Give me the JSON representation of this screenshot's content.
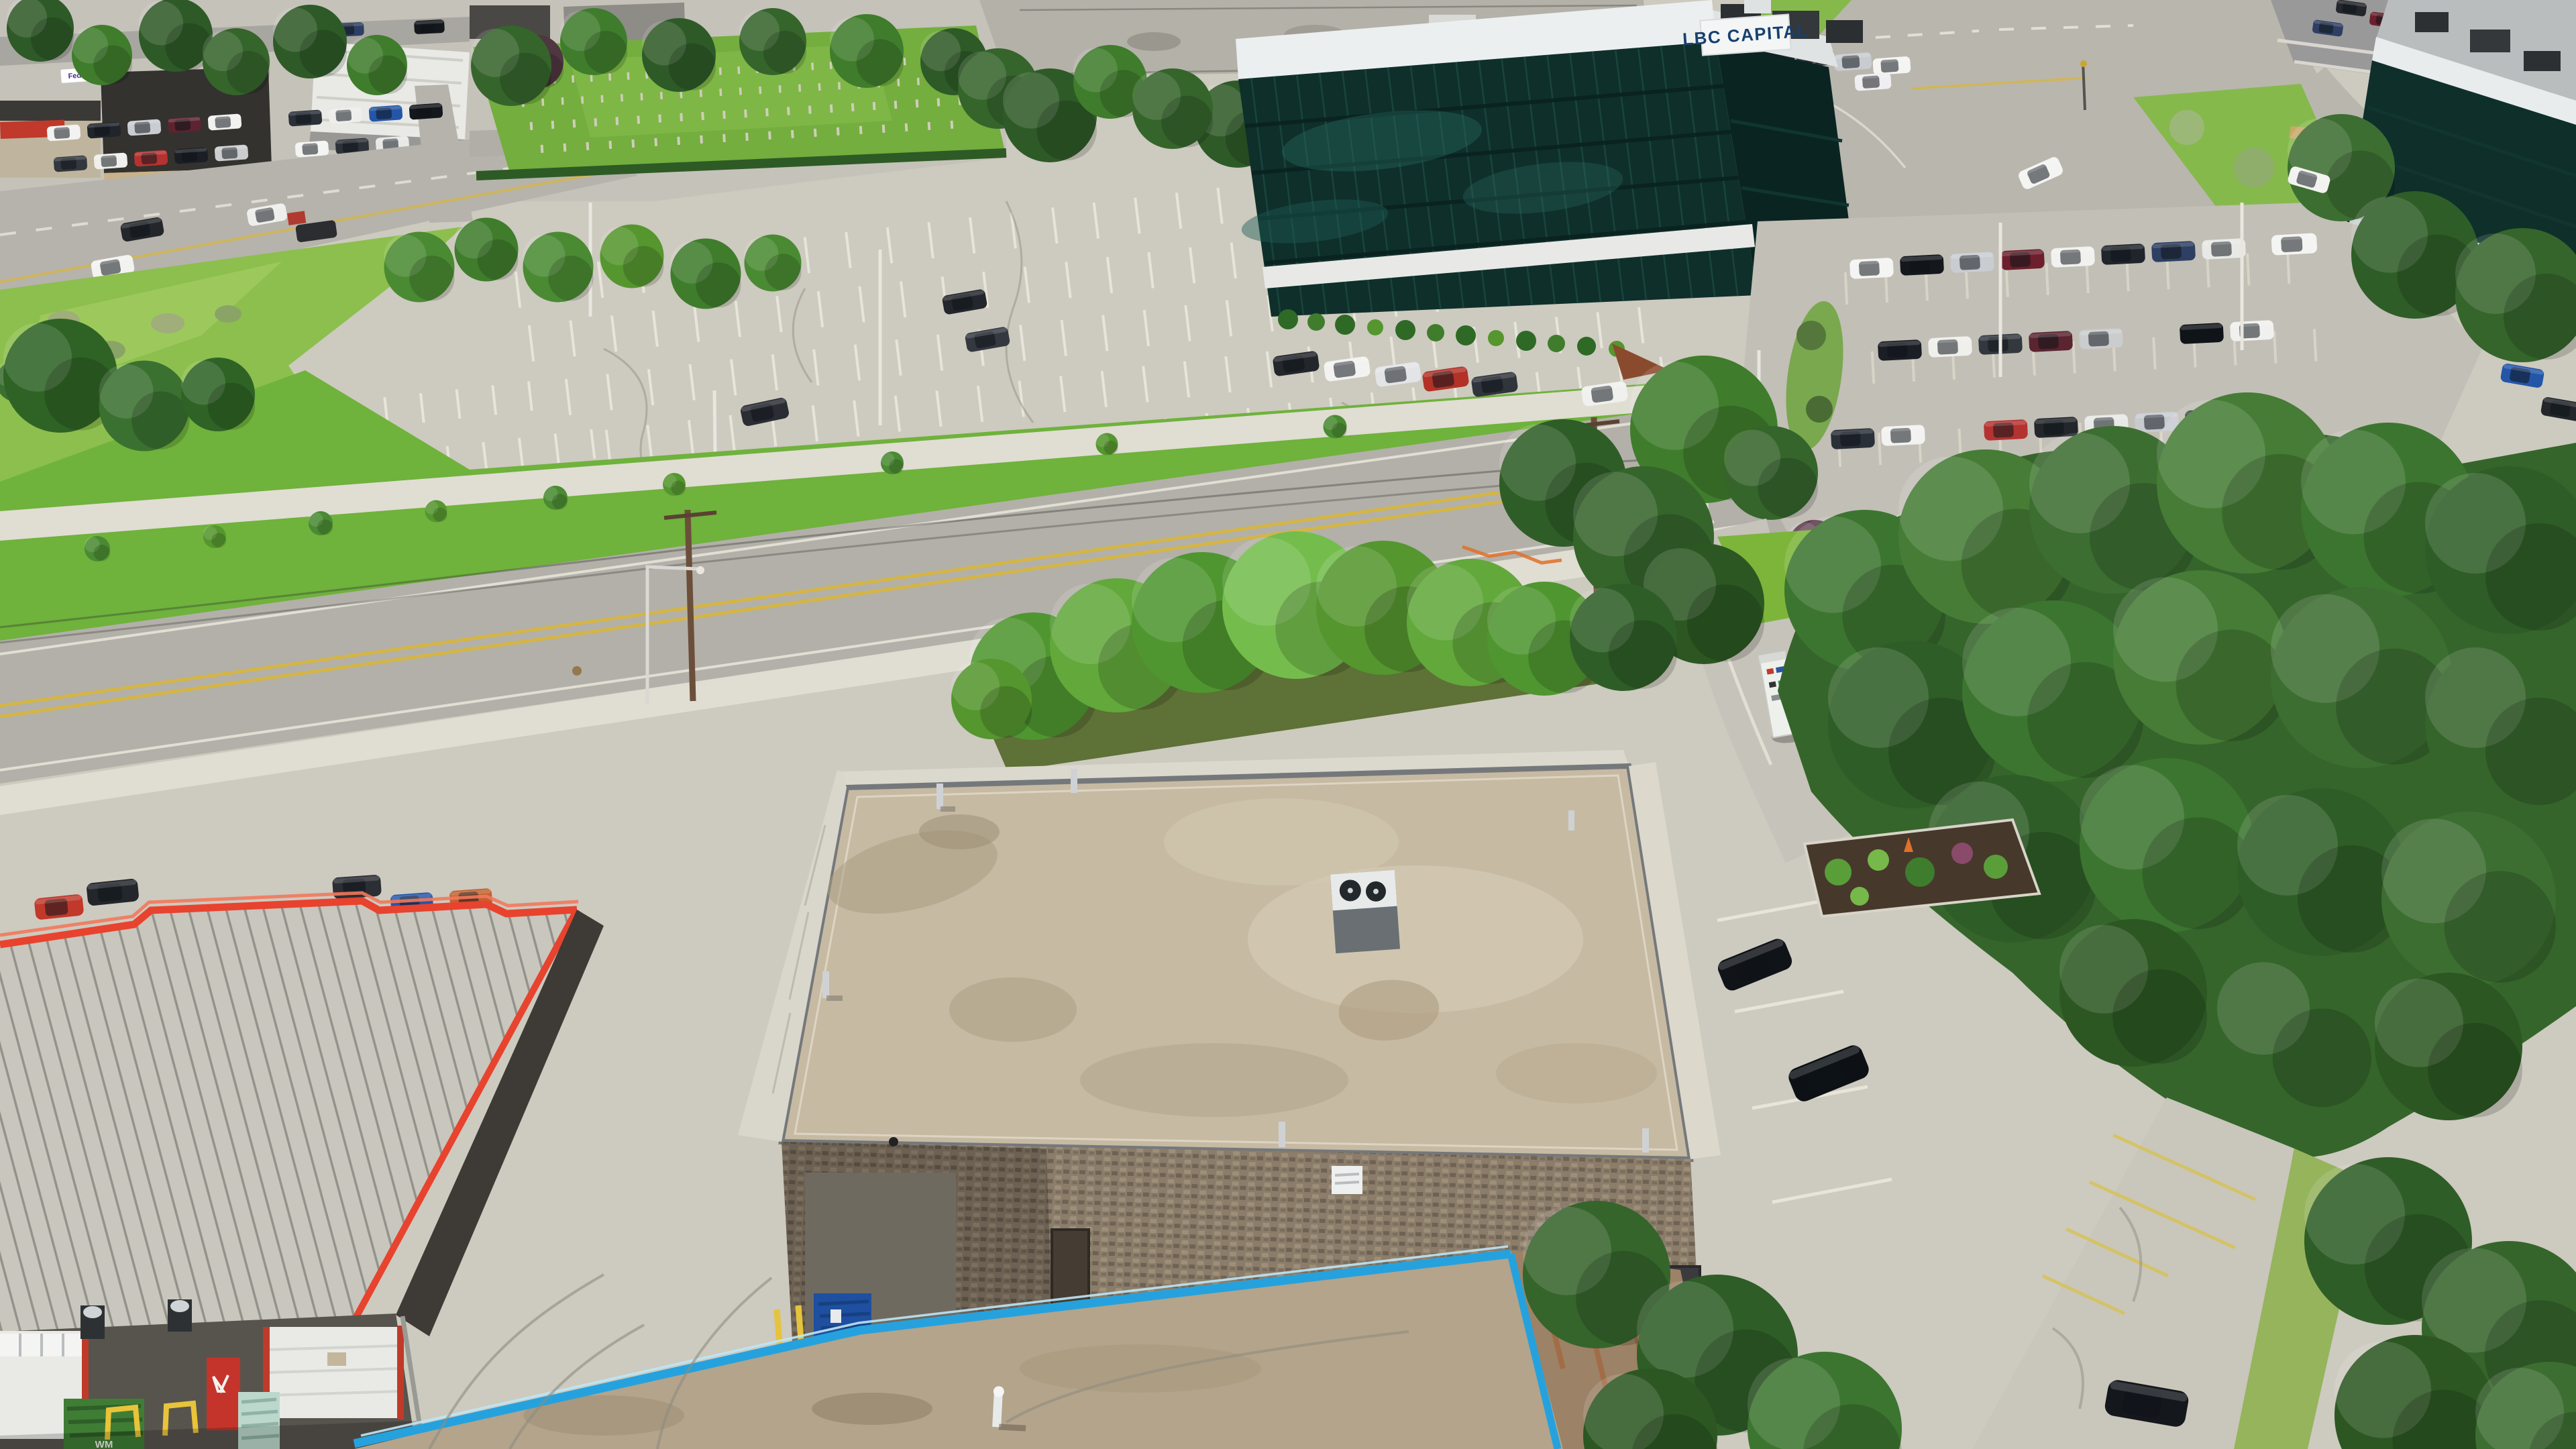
{
  "meta": {
    "type": "aerial-drone-photograph",
    "setting": "Suburban commercial and light-industrial district on a sunny summer midday",
    "view": "High oblique aerial view, no sky visible"
  },
  "texts": {
    "office_tower_sign": "LBC CAPITAL",
    "waste_bin_logo": "WM",
    "courier_truck_logo": "FedEx"
  },
  "palette": {
    "asphalt_light": "#cdcabf",
    "asphalt_road": "#b2b0a8",
    "concrete_sidewalk": "#e0ddd3",
    "grass_bright": "#8cbf4d",
    "grass_verge": "#6fb23c",
    "tree_dark": "#35652b",
    "tree_mid": "#4f9630",
    "tree_light": "#74bd4d",
    "glass_dark_teal": "#0f2f2b",
    "parapet_white": "#eceff0",
    "flat_roof_tan": "#c6baa3",
    "metal_roof_gray": "#c9c6bd",
    "trim_red": "#e8432e",
    "trim_cyan_blue": "#25a2de",
    "block_wall_brown": "#8b7d6a",
    "stall_line_white": "#eceadf",
    "stall_line_yellow": "#d8c24a",
    "centerline_yellow": "#d8b63c"
  },
  "scene": {
    "office_tower": {
      "label": "Dark-glass office tower",
      "sign": "LBC CAPITAL",
      "floors_visible": 5,
      "rooftop_units": 4
    },
    "second_tower": {
      "label": "Second glass office building, far right edge"
    },
    "empty_lot": {
      "label": "Large mostly-empty cracked parking lot",
      "parked_vehicles": 4,
      "light_poles": 4
    },
    "busy_lot": {
      "label": "Busy employee parking lot right of tower",
      "parked_vehicles": 40
    },
    "dealership_lot": {
      "label": "Top-left commercial strip and car lot",
      "parked_vehicles": 22
    },
    "cemetery": {
      "label": "Small cemetery lawn with headstone rows",
      "rows": 4
    },
    "main_road": {
      "label": "Two-lane arterial road",
      "marking": "double yellow centerline",
      "sidewalks": 2
    },
    "intersection": {
      "label": "Signalized intersection, top right",
      "queued_vehicles": 5
    },
    "highway": {
      "label": "Highway with guardrails, top right corner",
      "vehicles": 6
    },
    "foreground_building": {
      "label": "Flat tan gravel roof industrial building",
      "vents": 6,
      "rooftop_hvac": 1,
      "suvs_parked_east": 2,
      "dock_dumpster": "blue"
    },
    "left_building": {
      "label": "Metal standing-seam roof building with red trim",
      "garage_doors": 2,
      "entry_door": "red",
      "wall_hvac_units": 2,
      "dumpster": "green WM",
      "pallet": 1,
      "bollards": "yellow"
    },
    "bottom_building": {
      "label": "Flat roof with bright cyan-blue parapet trim",
      "vents": 1
    },
    "forest_right": {
      "label": "Dense green tree mass along right side"
    },
    "center_tree_row": {
      "label": "Row of mature deciduous trees south of road"
    },
    "pedestrian_count": 1,
    "utility": {
      "label": "Wood utility poles with power lines along road"
    }
  }
}
